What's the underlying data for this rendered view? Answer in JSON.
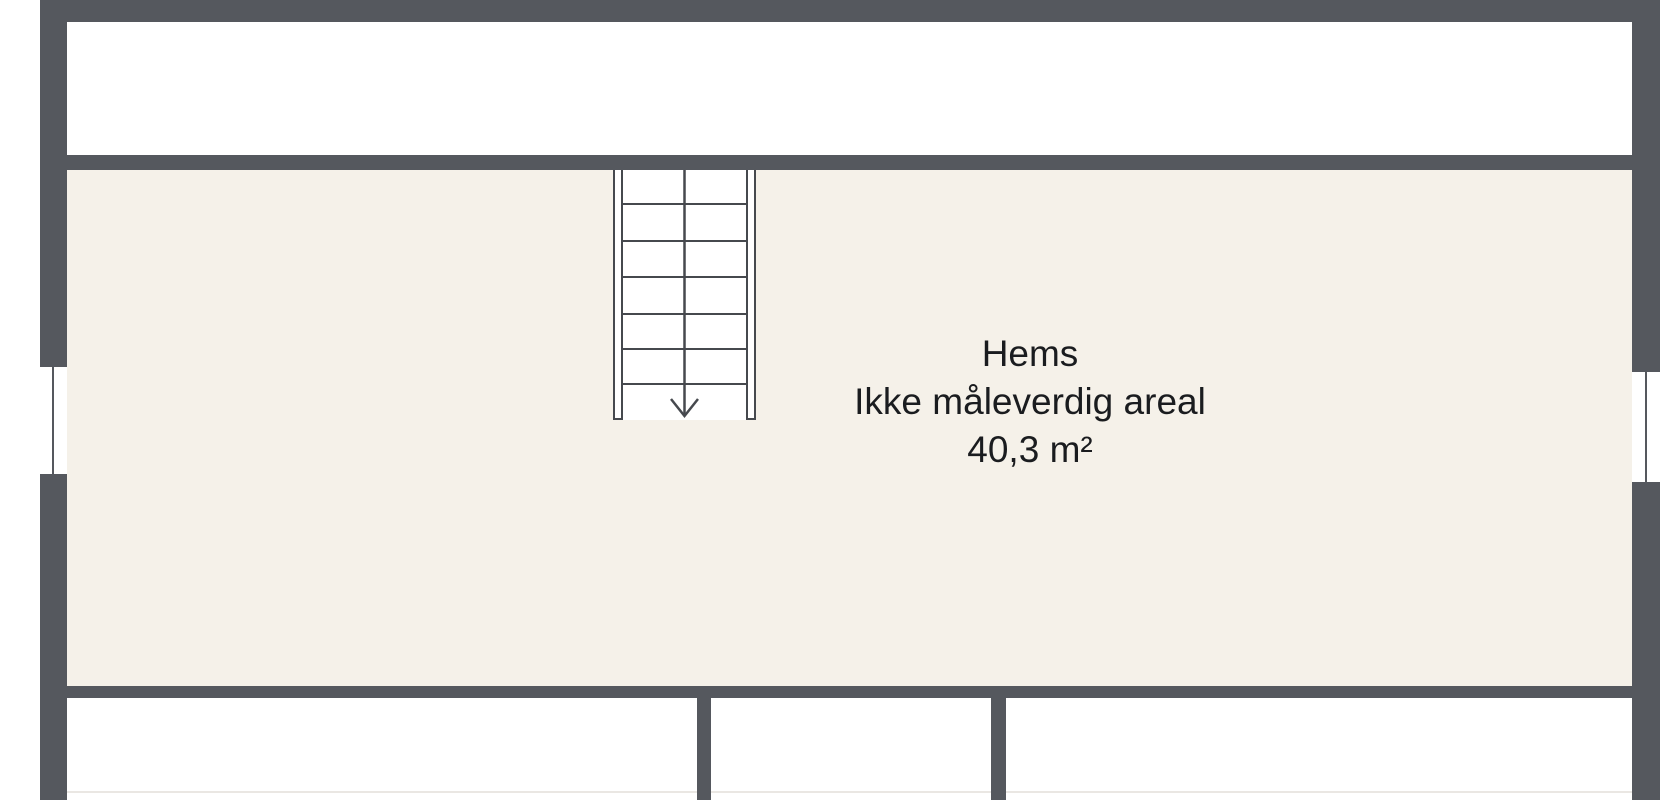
{
  "room_label": {
    "name": "Hems",
    "note": "Ikke måleverdig areal",
    "area": "40,3 m²"
  },
  "colors": {
    "wall": "#55585e",
    "room_fill": "#f5f1e9",
    "stair_line": "#46494e",
    "text": "#1a1c1f",
    "background": "#ffffff",
    "faint_line": "#eae7e3"
  }
}
